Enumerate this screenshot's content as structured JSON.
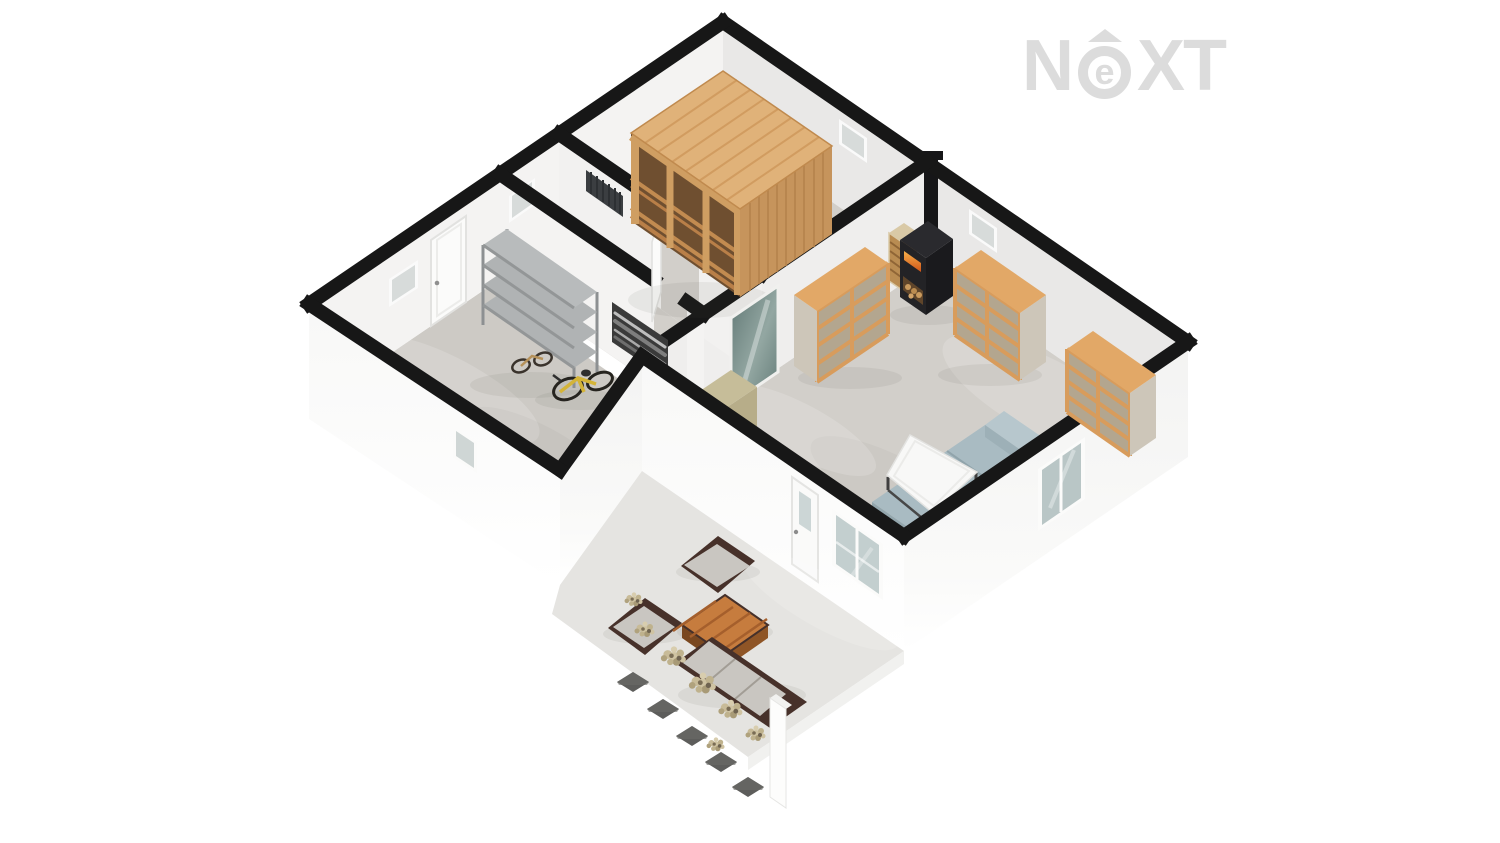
{
  "app": {
    "type": "3d-floorplan-render",
    "style": "isometric-cutaway-dollhouse",
    "background": "#ffffff"
  },
  "logo": {
    "part_n": "N",
    "part_e": "e",
    "part_xt": "XT",
    "icon": "caret-up",
    "color": "#dcdcdc"
  },
  "colors": {
    "background": "#ffffff",
    "wall_top": "#171717",
    "wall_face": "#e9e8e7",
    "wall_face_bright": "#f4f3f2",
    "exterior_wall": "#f5f5f4",
    "floor_concrete": "#d2cfca",
    "floor_garage": "#cdcac5",
    "terrace_slab": "#e5e4e1",
    "sauna_top": "#e0b279",
    "sauna_side": "#c6945c",
    "sauna_frame": "#cf9e62",
    "sauna_interior": "#6f4f30",
    "shelf_wood": "#e2a867",
    "shelf_front": "#d89c5c",
    "shelf_side": "#cdc6b9",
    "shelf_cell": "#b3a68f",
    "rack_gray": "#b0b3b4",
    "stove_black": "#232326",
    "fire_orange": "#ef8030",
    "firewood": "#c99a5e",
    "mirror_glass": "#6c8380",
    "sideboard": "#c6bd99",
    "sofa_blue": "#a9bbc2",
    "table_white": "#f8f8f7",
    "outdoor_brown": "#47312a",
    "outdoor_cushion": "#c9c6c1",
    "outdoor_table_wood": "#c67c3e",
    "bike_yellow": "#d4b438",
    "plant_beige": "#cfc3a2",
    "paver_gray": "#5d5d5b",
    "glass": "#ccd6d6",
    "logo_gray": "#dcdcdc"
  },
  "floorplan": {
    "rooms": [
      {
        "name": "sauna-room",
        "position": "top",
        "furniture": [
          "wooden-sauna-cabin"
        ],
        "windows": 1,
        "doors": [
          "open-door-to-hallway"
        ]
      },
      {
        "name": "hallway",
        "position": "middle-left",
        "furniture": [
          "radiator"
        ],
        "windows": 1
      },
      {
        "name": "garage-storage",
        "position": "left",
        "furniture": [
          "metal-shelving-rack",
          "framed-bw-photo",
          "yellow-bicycle",
          "kids-bicycle"
        ],
        "windows": 2,
        "doors": [
          "entrance-door"
        ]
      },
      {
        "name": "living-room",
        "position": "right",
        "furniture": [
          "wood-stove",
          "stove-chimney",
          "firewood-stack",
          "bookshelf-left",
          "bookshelf-mid",
          "bookshelf-corner",
          "wall-mirror",
          "sideboard",
          "sofa",
          "coffee-table"
        ],
        "windows": 3,
        "doors": [
          "terrace-door"
        ]
      },
      {
        "name": "terrace",
        "position": "bottom",
        "furniture": [
          "outdoor-armchair-1",
          "outdoor-armchair-2",
          "outdoor-sofa",
          "outdoor-coffee-table",
          "shrub-planters",
          "paving-stones",
          "low-white-wall"
        ]
      }
    ]
  }
}
